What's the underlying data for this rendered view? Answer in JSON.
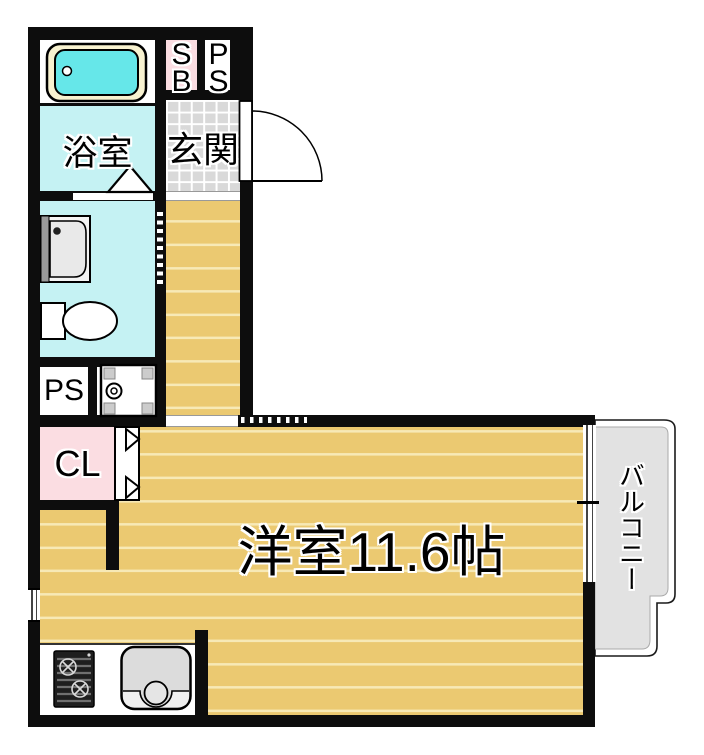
{
  "unit": {
    "plan_type": "floor-plan",
    "main_room_label": "洋室11.6帖",
    "balcony_label": "バルコニー",
    "bathroom_label": "浴室",
    "entrance_label": "玄関",
    "shoebox_line1": "S",
    "shoebox_line2": "B",
    "pipe_shaft_top_line1": "P",
    "pipe_shaft_top_line2": "S",
    "pipe_shaft_label": "PS",
    "closet_label": "CL"
  },
  "fixtures": [
    "bathtub",
    "washbasin",
    "toilet",
    "washing-machine-pan",
    "gas-stove",
    "kitchen-sink",
    "entrance-door-swing",
    "bathroom-door-triangle",
    "closet-folding-door",
    "washroom-sliding-door",
    "balcony-sliding-window",
    "side-window"
  ],
  "colors": {
    "wall": "#0d0d0d",
    "floor_wood": "#ebc971",
    "floor_plank_line": "#f7e9b6",
    "wet_room_cyan": "#c5f2f3",
    "accent_pink": "#fbdde2",
    "entrance_tile_gray": "#d9d9d9",
    "balcony_gray": "#e2e2e2",
    "tub_cyan": "#66e7e9",
    "tub_rim_cream": "#f8f2d0"
  }
}
